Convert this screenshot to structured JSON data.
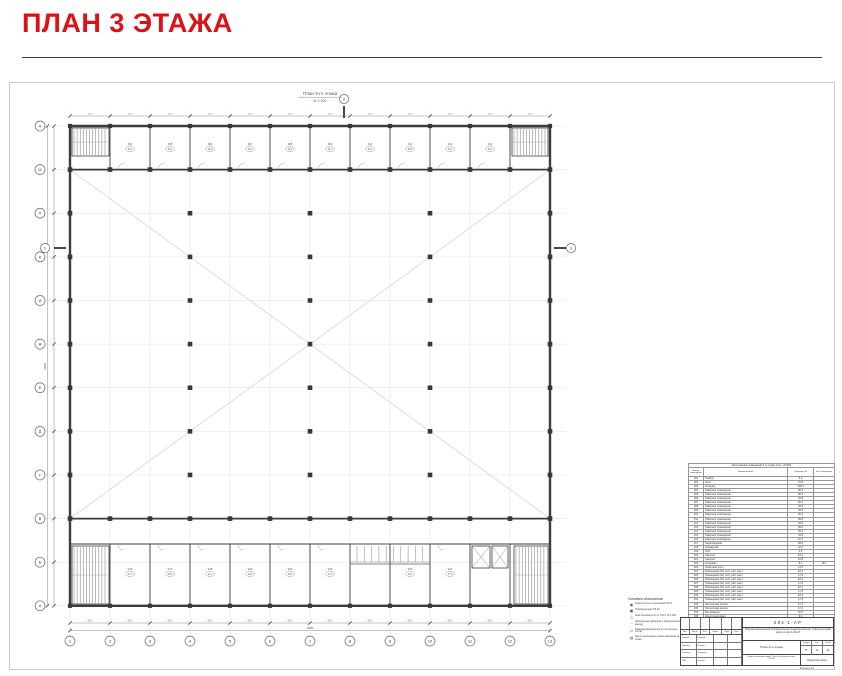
{
  "page": {
    "title": "ПЛАН 3 ЭТАЖА"
  },
  "colors": {
    "accent_red": "#dd1216",
    "wall": "#3c3c3c",
    "grid_light": "#dcdcdc",
    "frame": "#cbcbcb"
  },
  "drawing": {
    "title": "План 3-го этажа",
    "scale": "М 1:100",
    "grid_numbers": [
      "1",
      "2",
      "3",
      "4",
      "5",
      "6",
      "7",
      "8",
      "9",
      "10",
      "11",
      "12",
      "13"
    ],
    "grid_letters": [
      "Н",
      "М",
      "Л",
      "К",
      "И",
      "Ж",
      "Е",
      "Д",
      "Г",
      "В",
      "Б",
      "А"
    ],
    "bay_dim": "6000",
    "overall_width_dim": "72000",
    "overall_height_dim": "66000",
    "section_mark_1": "1",
    "section_mark_2": "2",
    "top_room_tags": [
      {
        "no": "304",
        "area": "35,2"
      },
      {
        "no": "305",
        "area": "36,4"
      },
      {
        "no": "306",
        "area": "34,8"
      },
      {
        "no": "307",
        "area": "36,1"
      },
      {
        "no": "308",
        "area": "35,6"
      },
      {
        "no": "309",
        "area": "34,3"
      },
      {
        "no": "310",
        "area": "36,2"
      },
      {
        "no": "311",
        "area": "35,8"
      },
      {
        "no": "312",
        "area": "34,5"
      },
      {
        "no": "313",
        "area": "36,0"
      }
    ],
    "bottom_room_tags": [
      {
        "no": "316",
        "area": "47,2"
      },
      {
        "no": "317",
        "area": "28,6"
      },
      {
        "no": "318",
        "area": "12,4"
      },
      {
        "no": "320",
        "area": "16,2"
      },
      {
        "no": "324",
        "area": "18,3"
      },
      {
        "no": "325",
        "area": "17,9"
      },
      {
        "no": "326",
        "area": "18,4"
      },
      {
        "no": "327",
        "area": "17,6"
      }
    ]
  },
  "schedule": {
    "title": "Экспликация помещений 3-го этажа (отм. +9,000)",
    "col_headers": [
      "Номер помещения",
      "Наименование",
      "Площадь, м²",
      "Кат. помещения"
    ],
    "rows": [
      [
        "301",
        "Тамбур",
        "5,2",
        ""
      ],
      [
        "302",
        "Холл",
        "76,8",
        ""
      ],
      [
        "303",
        "Коридор",
        "148,3",
        ""
      ],
      [
        "304",
        "Офисное помещение",
        "35,2",
        ""
      ],
      [
        "305",
        "Офисное помещение",
        "36,4",
        ""
      ],
      [
        "306",
        "Офисное помещение",
        "34,8",
        ""
      ],
      [
        "307",
        "Офисное помещение",
        "36,1",
        ""
      ],
      [
        "308",
        "Офисное помещение",
        "35,6",
        ""
      ],
      [
        "309",
        "Офисное помещение",
        "34,3",
        ""
      ],
      [
        "310",
        "Офисное помещение",
        "36,2",
        ""
      ],
      [
        "311",
        "Офисное помещение",
        "35,8",
        ""
      ],
      [
        "312",
        "Офисное помещение",
        "34,5",
        ""
      ],
      [
        "313",
        "Офисное помещение",
        "36,0",
        ""
      ],
      [
        "314",
        "Офисное помещение",
        "35,1",
        ""
      ],
      [
        "315",
        "Офисное помещение",
        "33,9",
        ""
      ],
      [
        "316",
        "Офисное помещение",
        "47,2",
        ""
      ],
      [
        "317",
        "Переговорная",
        "28,6",
        ""
      ],
      [
        "318",
        "Серверная",
        "12,4",
        ""
      ],
      [
        "319",
        "КУИ",
        "4,6",
        ""
      ],
      [
        "320",
        "Санузел",
        "16,2",
        ""
      ],
      [
        "321",
        "Санузел",
        "15,8",
        ""
      ],
      [
        "322",
        "Кладовая",
        "8,2",
        "В4"
      ],
      [
        "323",
        "Лифтовой холл",
        "14,6",
        ""
      ],
      [
        "324",
        "Помещение без пост. раб. мест",
        "18,3",
        ""
      ],
      [
        "325",
        "Помещение без пост. раб. мест",
        "17,9",
        ""
      ],
      [
        "326",
        "Помещение без пост. раб. мест",
        "18,4",
        ""
      ],
      [
        "327",
        "Помещение без пост. раб. мест",
        "17,6",
        ""
      ],
      [
        "328",
        "Помещение без пост. раб. мест",
        "18,1",
        ""
      ],
      [
        "329",
        "Помещение без пост. раб. мест",
        "17,8",
        ""
      ],
      [
        "330",
        "Помещение без пост. раб. мест",
        "18,2",
        ""
      ],
      [
        "331",
        "Помещение без пост. раб. мест",
        "17,5",
        ""
      ],
      [
        "332",
        "Лестничная клетка",
        "17,4",
        ""
      ],
      [
        "333",
        "Лестничная клетка",
        "17,4",
        ""
      ],
      [
        "334",
        "Венткамера",
        "22,6",
        ""
      ],
      [
        "335",
        "Электрощитовая",
        "9,4",
        ""
      ],
      [
        "336",
        "Санузел МГН",
        "5,6",
        ""
      ],
      [
        "337",
        "Коридор",
        "42,8",
        ""
      ],
      [
        "338",
        "КУИ",
        "3,9",
        ""
      ],
      [
        "339",
        "Балкон",
        "12,6",
        ""
      ],
      [
        "340",
        "Кладовая инвентаря",
        "6,8",
        ""
      ]
    ],
    "total_label": "Итого:",
    "total_value": "1716,4"
  },
  "legend": {
    "title": "Условные обозначения:",
    "items": [
      {
        "icon": "extinguisher-icon",
        "label": "Огнетушитель порошковый ОП-5"
      },
      {
        "icon": "fire-hydrant-icon",
        "label": "Пожарный кран ПК-15"
      },
      {
        "icon": "safety-sign-icon",
        "label": "Знак безопасности по ГОСТ 12.4.026"
      },
      {
        "icon": "evac-route-icon",
        "label": "Направление движения к эвакуационному выходу"
      },
      {
        "icon": "evac-exit-icon",
        "label": "Эвакуационный выход на лестничную клетку"
      },
      {
        "icon": "evac-plan-icon",
        "label": "Место размещения плана эвакуации на этаже"
      }
    ]
  },
  "titleblock": {
    "code": "284-1-АР",
    "project": "Многофункциональный производственно-складской комплекс. Офисно-бытовой корпус в осях 1-13/А-Н",
    "sheet_name": "План 3-го этажа",
    "stage_label": "Стадия",
    "sheet_label": "Лист",
    "sheets_label": "Листов",
    "stage": "П",
    "sheet": "9",
    "sheets": "13",
    "sign_cols": [
      "Изм.",
      "Кол.уч",
      "Лист",
      "№док.",
      "Подп.",
      "Дата"
    ],
    "sign_rows": [
      [
        "Разраб.",
        "Иванов"
      ],
      [
        "Провер.",
        "Петров"
      ],
      [
        "Н.контр.",
        "Смирнов"
      ],
      [
        "ГИП",
        "Козлов"
      ]
    ],
    "bottom_left": "Офисно-бытовой корпус. План 3-го этажа на отм. +9,000",
    "company": "Проектное бюро",
    "format": "Формат А3"
  }
}
